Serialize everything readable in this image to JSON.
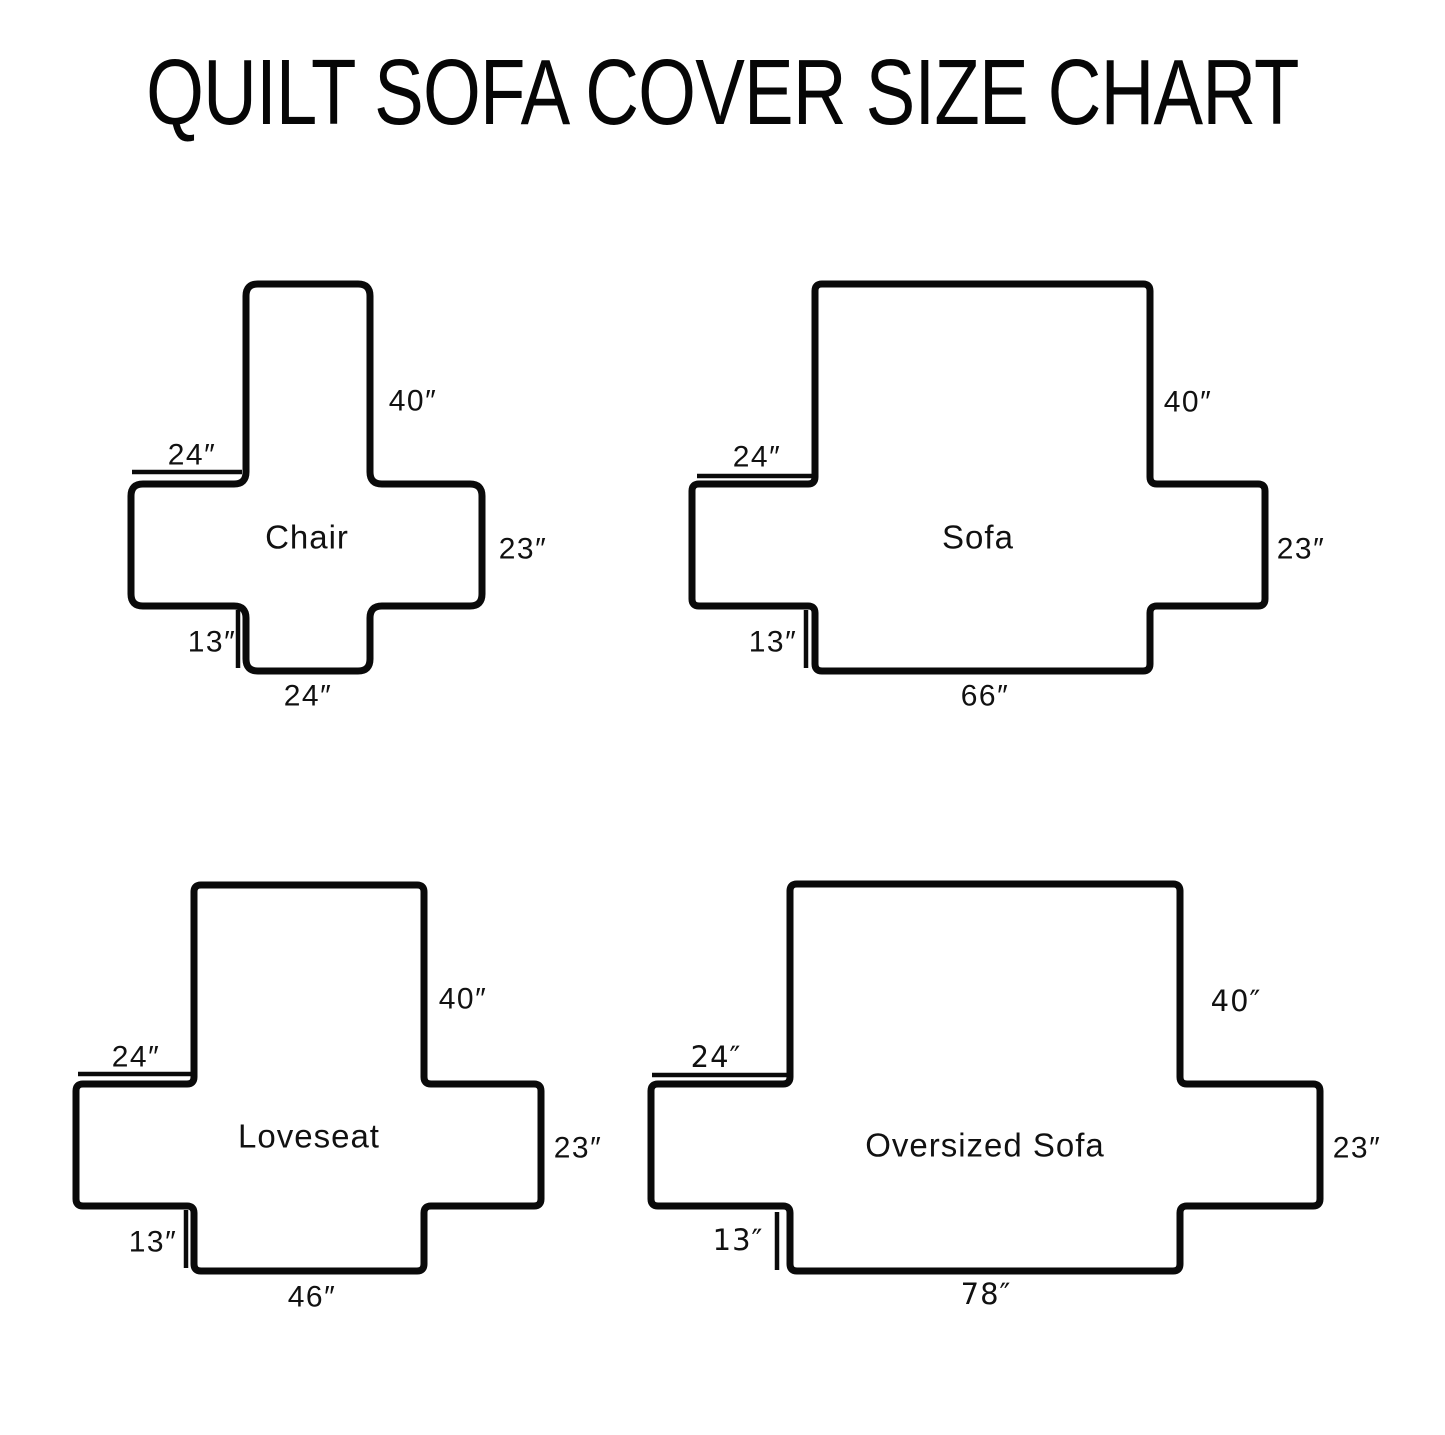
{
  "title": "QUILT SOFA COVER SIZE CHART",
  "colors": {
    "ink": "#0a0a0a",
    "background": "#ffffff"
  },
  "diagrams": [
    {
      "id": "chair",
      "name": "Chair",
      "name_pos": {
        "x": 307,
        "y": 537
      },
      "corner_radius": 12,
      "geometry": {
        "left": 131,
        "arm_left": 246,
        "arm_right": 370,
        "right": 482,
        "top": 284,
        "band_top": 484,
        "band_bottom": 606,
        "bottom": 671
      },
      "labels": [
        {
          "key": "back-height",
          "text": "40″",
          "x": 413,
          "y": 401,
          "bold": false
        },
        {
          "key": "arm-width",
          "text": "24″",
          "x": 192,
          "y": 455,
          "bold": false
        },
        {
          "key": "side-height",
          "text": "23″",
          "x": 523,
          "y": 549,
          "bold": false
        },
        {
          "key": "skirt-drop",
          "text": "13″",
          "x": 212,
          "y": 642,
          "bold": false
        },
        {
          "key": "seat-width",
          "text": "24″",
          "x": 308,
          "y": 696,
          "bold": false
        }
      ],
      "ticks": [
        {
          "key": "arm-width-tick",
          "x1": 132,
          "y1": 472,
          "x2": 242,
          "y2": 472
        },
        {
          "key": "skirt-drop-tick",
          "x1": 238,
          "y1": 610,
          "x2": 238,
          "y2": 668
        }
      ]
    },
    {
      "id": "sofa",
      "name": "Sofa",
      "name_pos": {
        "x": 978,
        "y": 537
      },
      "corner_radius": 7,
      "geometry": {
        "left": 692,
        "arm_left": 815,
        "arm_right": 1150,
        "right": 1265,
        "top": 284,
        "band_top": 484,
        "band_bottom": 606,
        "bottom": 671
      },
      "labels": [
        {
          "key": "back-height",
          "text": "40″",
          "x": 1188,
          "y": 402,
          "bold": false
        },
        {
          "key": "arm-width",
          "text": "24″",
          "x": 757,
          "y": 457,
          "bold": false
        },
        {
          "key": "side-height",
          "text": "23″",
          "x": 1301,
          "y": 549,
          "bold": false
        },
        {
          "key": "skirt-drop",
          "text": "13″",
          "x": 773,
          "y": 642,
          "bold": false
        },
        {
          "key": "seat-width",
          "text": "66″",
          "x": 985,
          "y": 696,
          "bold": false
        }
      ],
      "ticks": [
        {
          "key": "arm-width-tick",
          "x1": 697,
          "y1": 476,
          "x2": 812,
          "y2": 476
        },
        {
          "key": "skirt-drop-tick",
          "x1": 806,
          "y1": 610,
          "x2": 806,
          "y2": 668
        }
      ]
    },
    {
      "id": "loveseat",
      "name": "Loveseat",
      "name_pos": {
        "x": 309,
        "y": 1136
      },
      "corner_radius": 7,
      "geometry": {
        "left": 76,
        "arm_left": 194,
        "arm_right": 424,
        "right": 541,
        "top": 885,
        "band_top": 1084,
        "band_bottom": 1206,
        "bottom": 1271
      },
      "labels": [
        {
          "key": "back-height",
          "text": "40″",
          "x": 463,
          "y": 999,
          "bold": false
        },
        {
          "key": "arm-width",
          "text": "24″",
          "x": 136,
          "y": 1057,
          "bold": false
        },
        {
          "key": "side-height",
          "text": "23″",
          "x": 578,
          "y": 1148,
          "bold": false
        },
        {
          "key": "skirt-drop",
          "text": "13″",
          "x": 153,
          "y": 1242,
          "bold": false
        },
        {
          "key": "seat-width",
          "text": "46″",
          "x": 312,
          "y": 1297,
          "bold": false
        }
      ],
      "ticks": [
        {
          "key": "arm-width-tick",
          "x1": 78,
          "y1": 1074,
          "x2": 192,
          "y2": 1074
        },
        {
          "key": "skirt-drop-tick",
          "x1": 186,
          "y1": 1210,
          "x2": 186,
          "y2": 1268
        }
      ]
    },
    {
      "id": "oversized-sofa",
      "name": "Oversized Sofa",
      "name_pos": {
        "x": 985,
        "y": 1145
      },
      "corner_radius": 7,
      "geometry": {
        "left": 651,
        "arm_left": 790,
        "arm_right": 1180,
        "right": 1320,
        "top": 884,
        "band_top": 1084,
        "band_bottom": 1206,
        "bottom": 1271
      },
      "labels": [
        {
          "key": "back-height",
          "text": "40″",
          "x": 1236,
          "y": 1001,
          "bold": true
        },
        {
          "key": "arm-width",
          "text": "24″",
          "x": 716,
          "y": 1057,
          "bold": true
        },
        {
          "key": "side-height",
          "text": "23″",
          "x": 1357,
          "y": 1148,
          "bold": false
        },
        {
          "key": "skirt-drop",
          "text": "13″",
          "x": 738,
          "y": 1240,
          "bold": true
        },
        {
          "key": "seat-width",
          "text": "78″",
          "x": 986,
          "y": 1294,
          "bold": true
        }
      ],
      "ticks": [
        {
          "key": "arm-width-tick",
          "x1": 652,
          "y1": 1075,
          "x2": 788,
          "y2": 1075
        },
        {
          "key": "skirt-drop-tick",
          "x1": 777,
          "y1": 1212,
          "x2": 777,
          "y2": 1270
        }
      ]
    }
  ],
  "stroke": {
    "outline_width": 7,
    "tick_width": 4.5
  }
}
